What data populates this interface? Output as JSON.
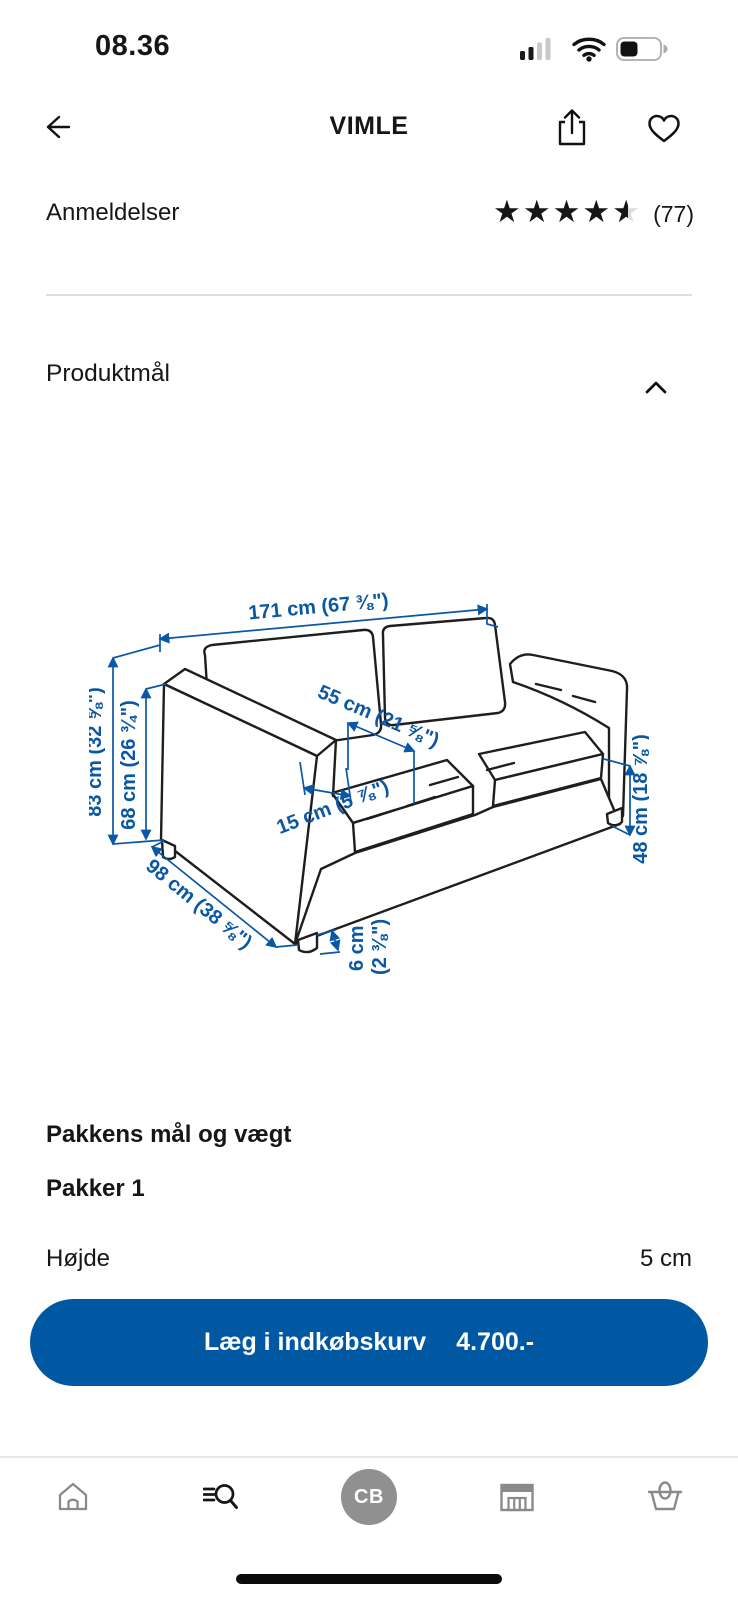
{
  "status_bar": {
    "time": "08.36"
  },
  "header": {
    "title": "VIMLE"
  },
  "reviews": {
    "label": "Anmeldelser",
    "count": "(77)"
  },
  "sections": {
    "product_dimensions_title": "Produktmål"
  },
  "diagram": {
    "labels": {
      "width": "171 cm (67 ⅜\")",
      "total_height": "83 cm (32 ⅝\")",
      "arm_height": "68 cm (26 ¾\")",
      "seat_depth": "55 cm (21 ⅝\")",
      "arm_width": "15 cm (5 ⅞\")",
      "depth": "98 cm (38 ⅝\")",
      "seat_height": "48 cm (18 ⅞\")",
      "leg_height_cm": "6 cm",
      "leg_height_in": "(2 ⅜\")"
    }
  },
  "package": {
    "heading": "Pakkens mål og vægt",
    "group": "Pakker 1",
    "rows": [
      {
        "label": "Højde",
        "value": "5 cm"
      }
    ]
  },
  "cta": {
    "label": "Læg i indkøbskurv",
    "price": "4.700.-"
  },
  "bottom_nav": {
    "avatar_initials": "CB"
  },
  "colors": {
    "ikea_blue": "#0058A3",
    "dimension_blue": "#0a57a3"
  }
}
